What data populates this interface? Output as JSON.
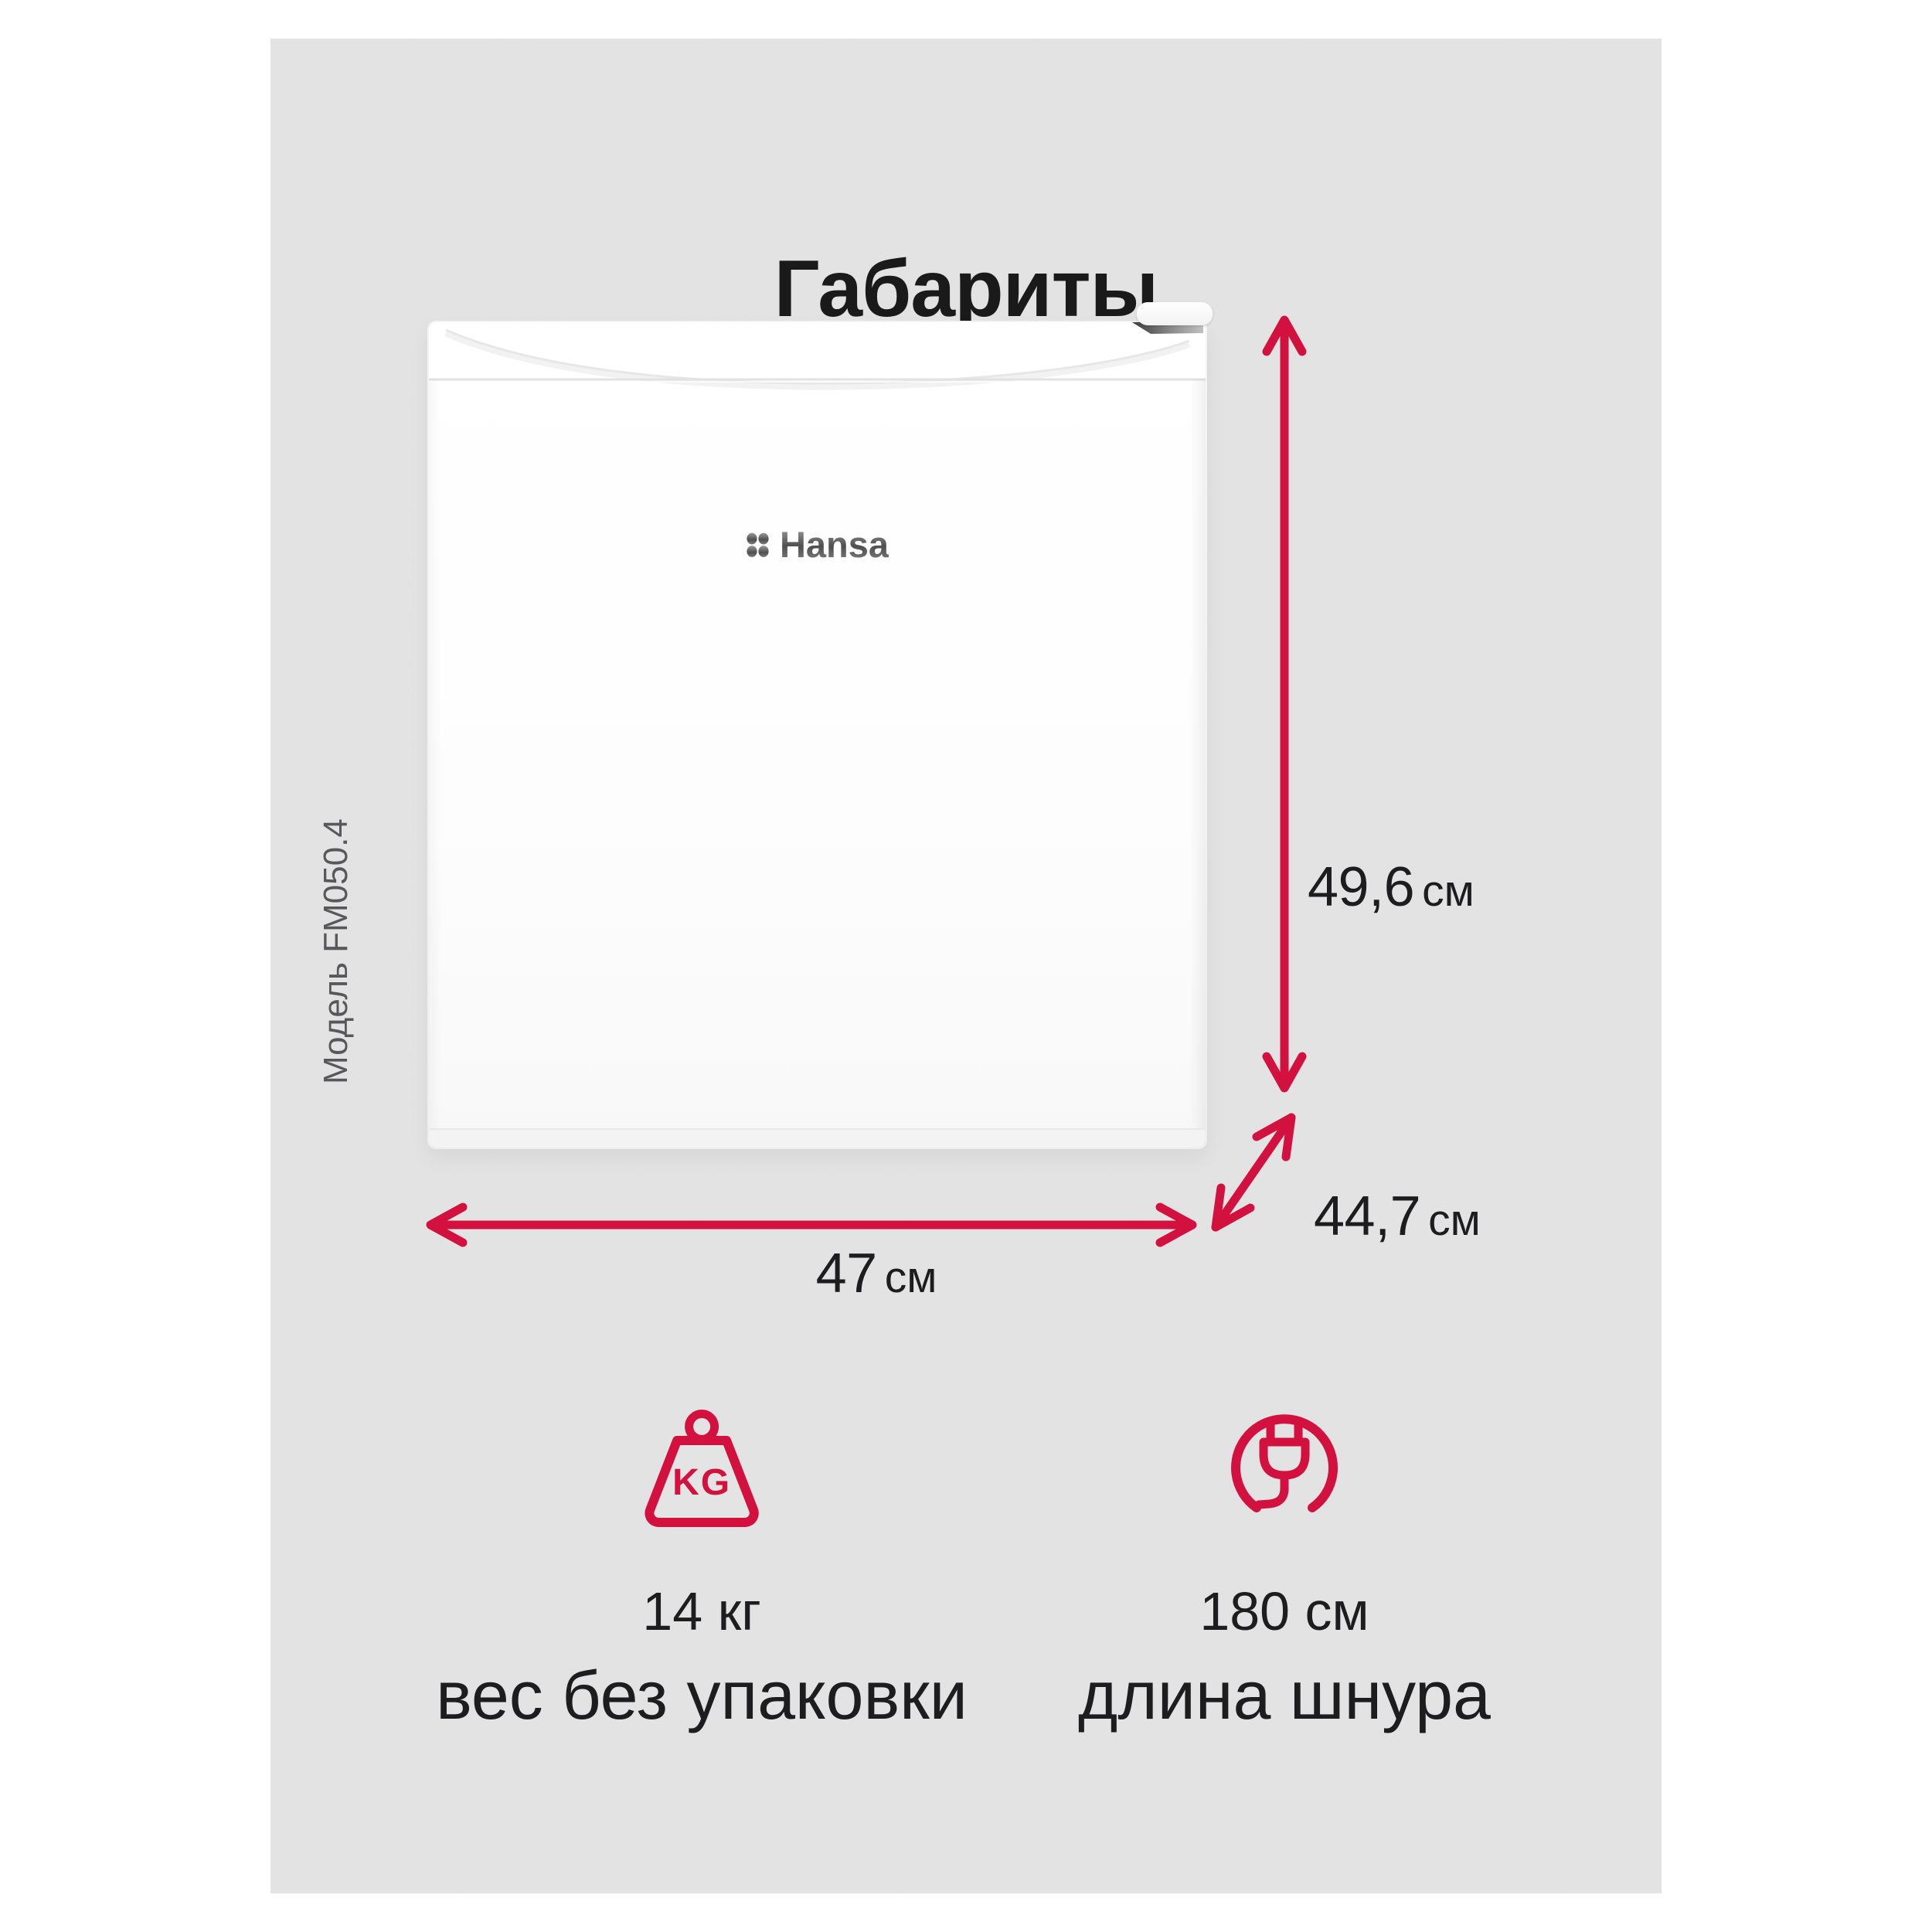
{
  "page": {
    "title": "Габариты"
  },
  "product": {
    "brand": "Hansa",
    "model_label": "Модель FM050.4"
  },
  "dims": {
    "height_value": "49,6",
    "height_unit": "см",
    "depth_value": "44,7",
    "depth_unit": "см",
    "width_value": "47",
    "width_unit": "см"
  },
  "weight_icon_label": "KG",
  "features": [
    {
      "icon": "weight-kg-icon",
      "value": "14 кг",
      "caption": "вес без упаковки"
    },
    {
      "icon": "power-plug-icon",
      "value": "180 см",
      "caption": "длина шнура"
    }
  ],
  "colors": {
    "accent_red": "#d2113e",
    "panel_gray": "#e4e4e4",
    "text_dark": "#1d1d1f",
    "muted_gray": "#58585a",
    "logo_gray": "#6e6e6e"
  }
}
